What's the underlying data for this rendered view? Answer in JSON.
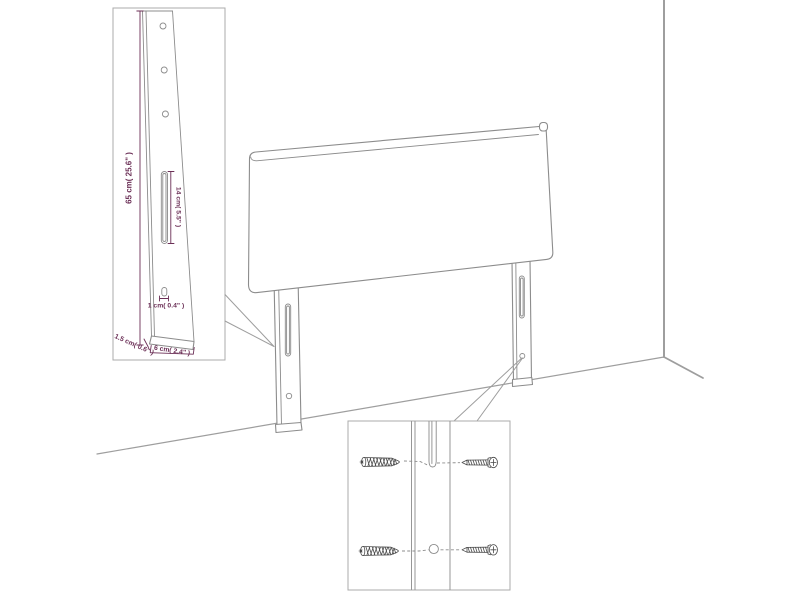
{
  "title": "headboard wall-mount assembly diagram",
  "colors": {
    "dimension_text": "#6b2f56",
    "furniture_line": "#8c8c8c",
    "wall_line": "#9e9e9e",
    "inset_border": "#ababab",
    "hardware_line": "#4a4a4a",
    "background": "#ffffff"
  },
  "main_view": {
    "parts": [
      "headboard-panel",
      "left-mounting-leg",
      "right-mounting-leg",
      "room-corner-wall",
      "floor-line"
    ]
  },
  "leg_detail_inset": {
    "labels": {
      "height": "65 cm( 25.6\" )",
      "slot_length": "14 cm( 5.5\" )",
      "hook_size": "1 cm( 0.4\" )",
      "thickness": "1.5 cm( 0.6\" )",
      "width": "6 cm( 2.4\" )"
    }
  },
  "hardware_detail_inset": {
    "items": [
      "wall-plug",
      "screw",
      "wall-plug",
      "screw"
    ]
  }
}
